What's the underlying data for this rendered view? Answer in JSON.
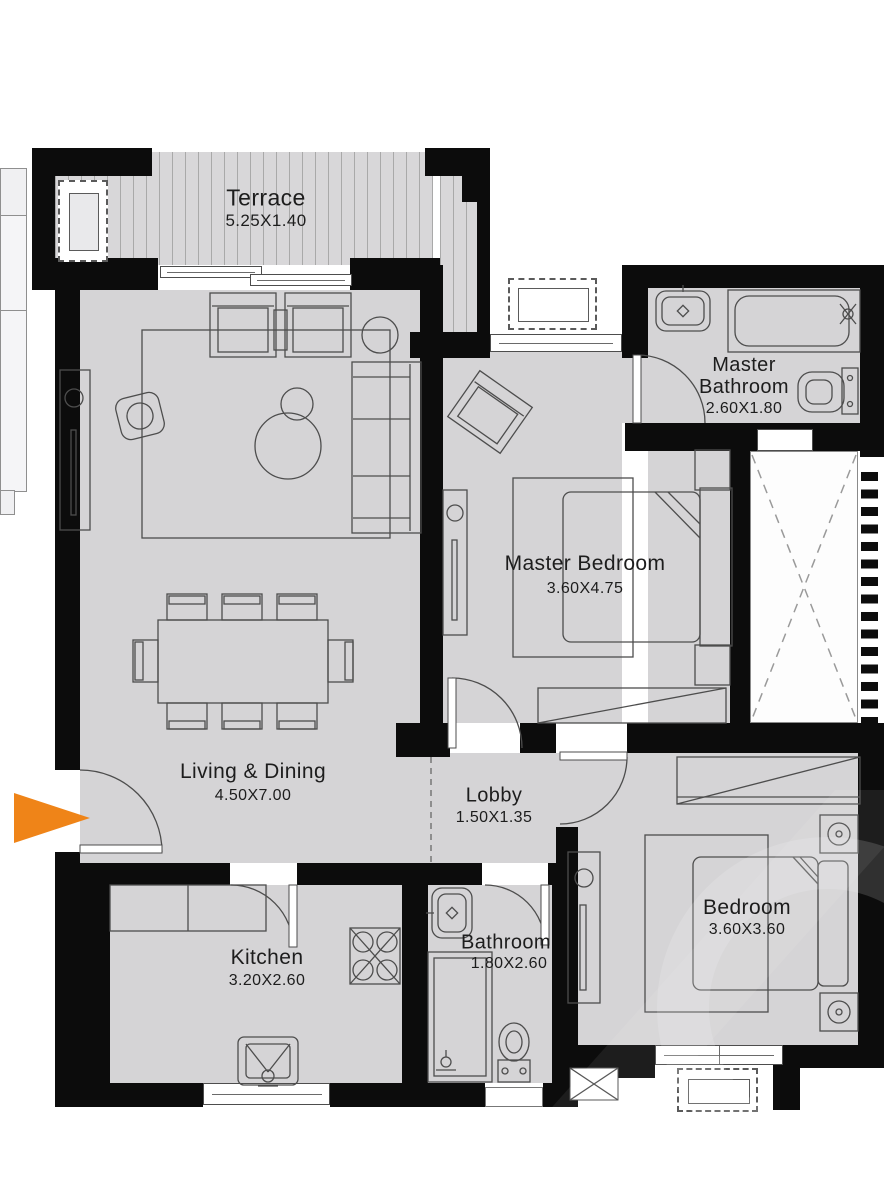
{
  "floorplan": {
    "rooms": [
      {
        "name": "Terrace",
        "dims": "5.25X1.40"
      },
      {
        "name": "Living & Dining",
        "dims": "4.50X7.00"
      },
      {
        "name": "Master Bedroom",
        "dims": "3.60X4.75"
      },
      {
        "name": "Master Bathroom",
        "dims": "2.60X1.80"
      },
      {
        "name": "Lobby",
        "dims": "1.50X1.35"
      },
      {
        "name": "Kitchen",
        "dims": "3.20X2.60"
      },
      {
        "name": "Bathroom",
        "dims": "1.80X2.60"
      },
      {
        "name": "Bedroom",
        "dims": "3.60X3.60"
      }
    ],
    "colors": {
      "wall": "#0c0c0c",
      "floor": "#d5d4d6",
      "terrace_stripe": "#a9a9a9",
      "furniture_outline": "#4d4d4d",
      "entrance_arrow": "#ef8418",
      "background": "#ffffff"
    },
    "icons": {
      "entrance_arrow": "entrance-arrow-icon"
    }
  }
}
